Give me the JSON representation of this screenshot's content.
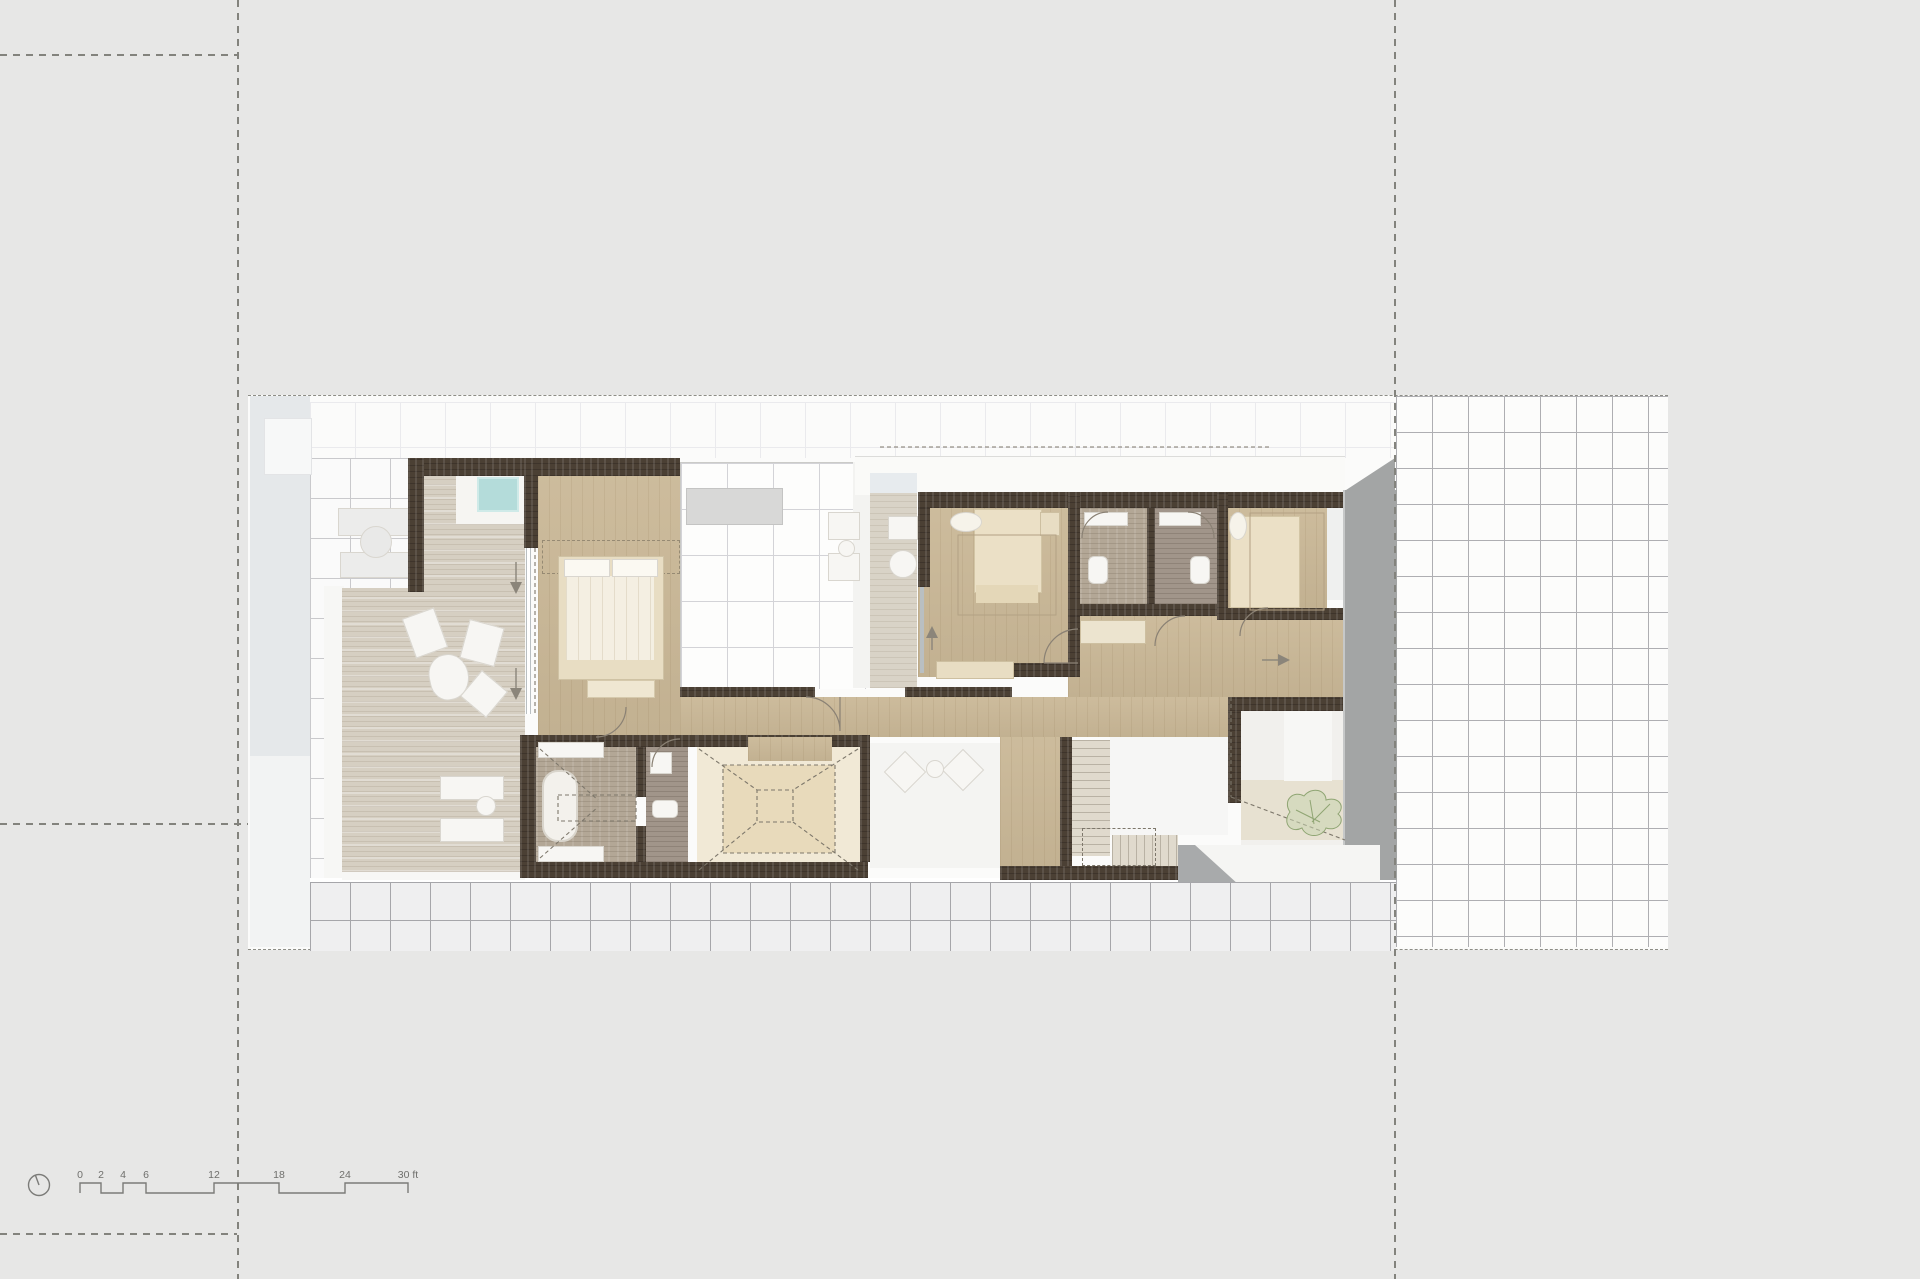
{
  "page": {
    "kind": "architectural floor plan sheet",
    "floor": "upper floor plan"
  },
  "colors": {
    "bg": "#e7e7e6",
    "site_bg": "#fbfbfa",
    "grid_faint": "#eaeaed",
    "grid_med": "#c9c9cc",
    "grid_strong": "#aeaeb2",
    "sidewalk_bg": "#efeff0",
    "sidewalk_line": "#a6a6aa",
    "pool_strip": "#e5e8ea",
    "boundary": "#8d8d86",
    "guide": "#83837d",
    "wall": "#4b4034",
    "wall_hi": "#6a5c46",
    "wood": "#cab897",
    "cream": "#e8ddc3",
    "cream_light": "#f4efe2",
    "white_soft": "#f4f4f2",
    "aqua": "#b4dcda",
    "travertine": "#d6cfc2",
    "trav_dark": "#b3a796",
    "bath_dark": "#a1958a",
    "concrete": "#a3a5a5",
    "skylight_outer": "#f1e9d6",
    "skylight_inner": "#e8dabb",
    "plant_stroke": "#8fa573",
    "plant_fill": "#c9d6b0",
    "line": "#7b7b78",
    "text": "#6f6f6c",
    "arcline": "#8a8174",
    "dashline": "#7d776b",
    "glass": "#b9bfc2"
  },
  "scale_bar": {
    "labels": [
      "0",
      "2",
      "4",
      "6",
      "12",
      "18",
      "24",
      "30 ft"
    ],
    "units": "ft"
  }
}
